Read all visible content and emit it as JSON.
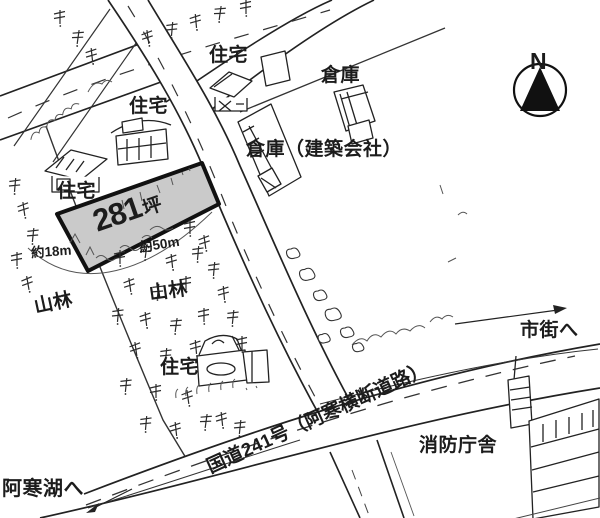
{
  "map": {
    "plot": {
      "area_value": "281",
      "area_unit": "坪",
      "frontage_label": "約18m",
      "depth_label": "約50m"
    },
    "labels": {
      "residential": "住宅",
      "warehouse": "倉庫",
      "warehouse_company": "倉庫（建築会社）",
      "forest": "山林",
      "fire_station": "消防庁舎"
    },
    "roads": {
      "route241": "国道241号（阿寒横断道路）"
    },
    "directions": {
      "to_city": "市街へ",
      "to_lake_akan": "阿寒湖へ"
    },
    "compass": {
      "north": "N"
    },
    "colors": {
      "ink": "#222222",
      "plot_fill": "#cacaca",
      "paper": "#ffffff"
    }
  }
}
